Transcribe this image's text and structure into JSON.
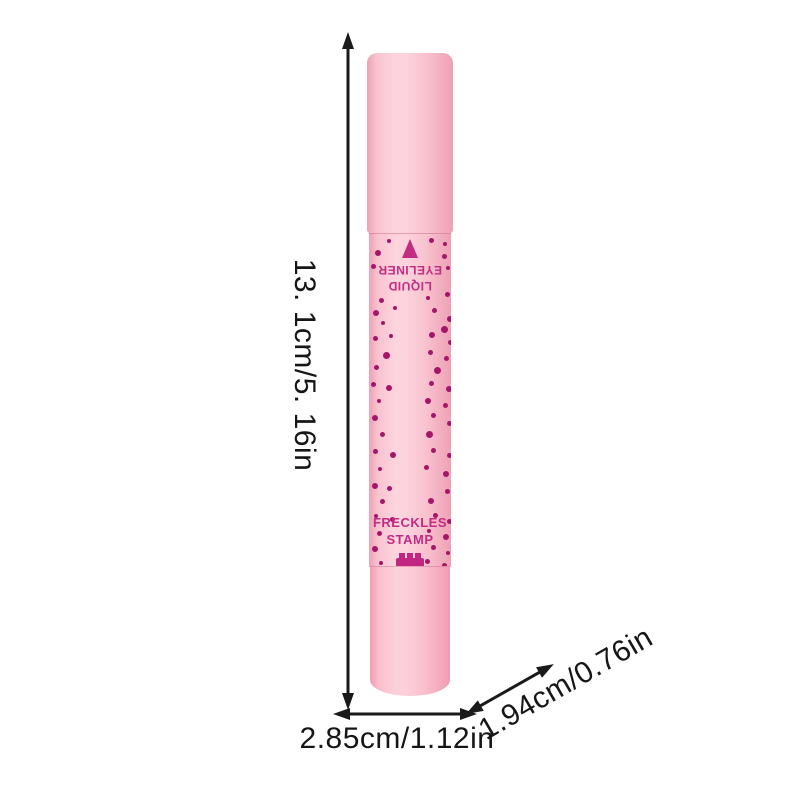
{
  "dimensions": {
    "height": "13. 1cm/5. 16in",
    "width": "2.85cm/1.12in",
    "depth": "1.94cm/0.76in"
  },
  "product": {
    "cap_end_label": {
      "line1": "LIQUID",
      "line2": "EYELINER",
      "icon": "eyeliner-tip-triangle"
    },
    "front_label": {
      "line1": "FRECKLES",
      "line2": "STAMP",
      "icon": "stamp-icon"
    },
    "colors": {
      "canvas_bg": "#ffffff",
      "arrow_ink": "#1a1a1a",
      "pink_light": "#fdd4dd",
      "pink_mid": "#f9c3d0",
      "pink_edge": "#eda1b5",
      "dot": "#a5156a",
      "label_magenta": "#c22c82",
      "stamp_magenta": "#c12680"
    },
    "dots": [
      [
        18,
        5,
        4
      ],
      [
        60,
        4,
        5
      ],
      [
        74,
        8,
        4
      ],
      [
        6,
        16,
        6
      ],
      [
        73,
        20,
        5
      ],
      [
        2,
        30,
        5
      ],
      [
        77,
        32,
        4
      ],
      [
        10,
        64,
        5
      ],
      [
        57,
        62,
        4
      ],
      [
        76,
        58,
        5
      ],
      [
        4,
        76,
        6
      ],
      [
        24,
        72,
        4
      ],
      [
        63,
        74,
        5
      ],
      [
        78,
        82,
        6
      ],
      [
        12,
        87,
        4
      ],
      [
        72,
        92,
        7
      ],
      [
        4,
        102,
        5
      ],
      [
        20,
        100,
        4
      ],
      [
        60,
        98,
        6
      ],
      [
        79,
        106,
        5
      ],
      [
        14,
        118,
        7
      ],
      [
        59,
        116,
        5
      ],
      [
        75,
        122,
        5
      ],
      [
        5,
        131,
        5
      ],
      [
        65,
        133,
        7
      ],
      [
        2,
        148,
        5
      ],
      [
        17,
        151,
        6
      ],
      [
        60,
        147,
        5
      ],
      [
        77,
        152,
        6
      ],
      [
        8,
        165,
        4
      ],
      [
        56,
        164,
        6
      ],
      [
        74,
        169,
        5
      ],
      [
        3,
        181,
        6
      ],
      [
        62,
        179,
        5
      ],
      [
        78,
        187,
        5
      ],
      [
        11,
        198,
        5
      ],
      [
        57,
        197,
        7
      ],
      [
        4,
        215,
        5
      ],
      [
        21,
        218,
        6
      ],
      [
        62,
        214,
        5
      ],
      [
        78,
        219,
        5
      ],
      [
        9,
        233,
        4
      ],
      [
        55,
        231,
        5
      ],
      [
        74,
        237,
        6
      ],
      [
        3,
        249,
        6
      ],
      [
        18,
        252,
        5
      ],
      [
        76,
        255,
        5
      ],
      [
        11,
        265,
        5
      ],
      [
        59,
        264,
        6
      ],
      [
        5,
        280,
        4
      ],
      [
        21,
        283,
        5
      ],
      [
        64,
        279,
        5
      ],
      [
        78,
        285,
        5
      ],
      [
        8,
        297,
        5
      ],
      [
        58,
        295,
        4
      ],
      [
        74,
        300,
        6
      ],
      [
        3,
        312,
        6
      ],
      [
        62,
        311,
        5
      ],
      [
        77,
        317,
        4
      ],
      [
        10,
        327,
        4
      ],
      [
        56,
        325,
        5
      ],
      [
        73,
        329,
        5
      ]
    ]
  }
}
